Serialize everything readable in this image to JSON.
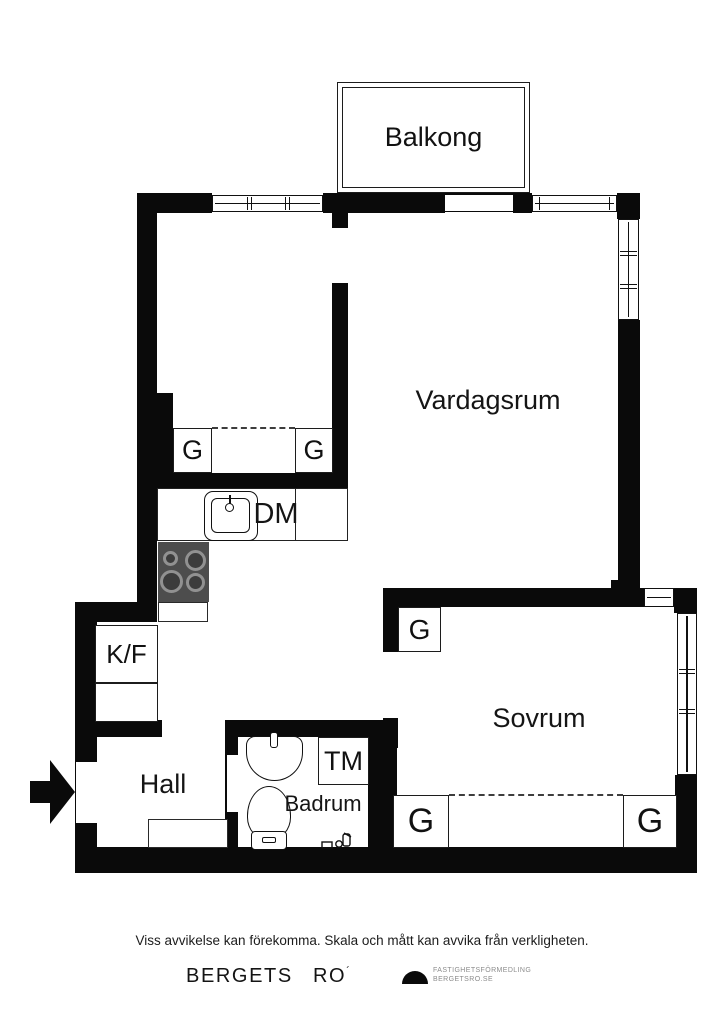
{
  "plan": {
    "rooms": {
      "balcony": "Balkong",
      "living_room": "Vardagsrum",
      "bedroom": "Sovrum",
      "hall": "Hall",
      "bathroom": "Badrum"
    },
    "fixtures": {
      "closet": "G",
      "fridge_freezer": "K/F",
      "dishwasher": "DM",
      "washing_machine": "TM"
    }
  },
  "footer": {
    "disclaimer": "Viss avvikelse kan förekomma. Skala och mått kan avvika från verkligheten.",
    "brand_word_1": "BERGETS",
    "brand_word_2": "RO",
    "brand_mark": "´",
    "logo_line_1": "FASTIGHETSFÖRMEDLING",
    "logo_line_2": "BERGETSRO.SE"
  },
  "colors": {
    "wall": "#0a0a0a",
    "stove": "#4d4d4d",
    "muted": "#8c8c8c"
  }
}
